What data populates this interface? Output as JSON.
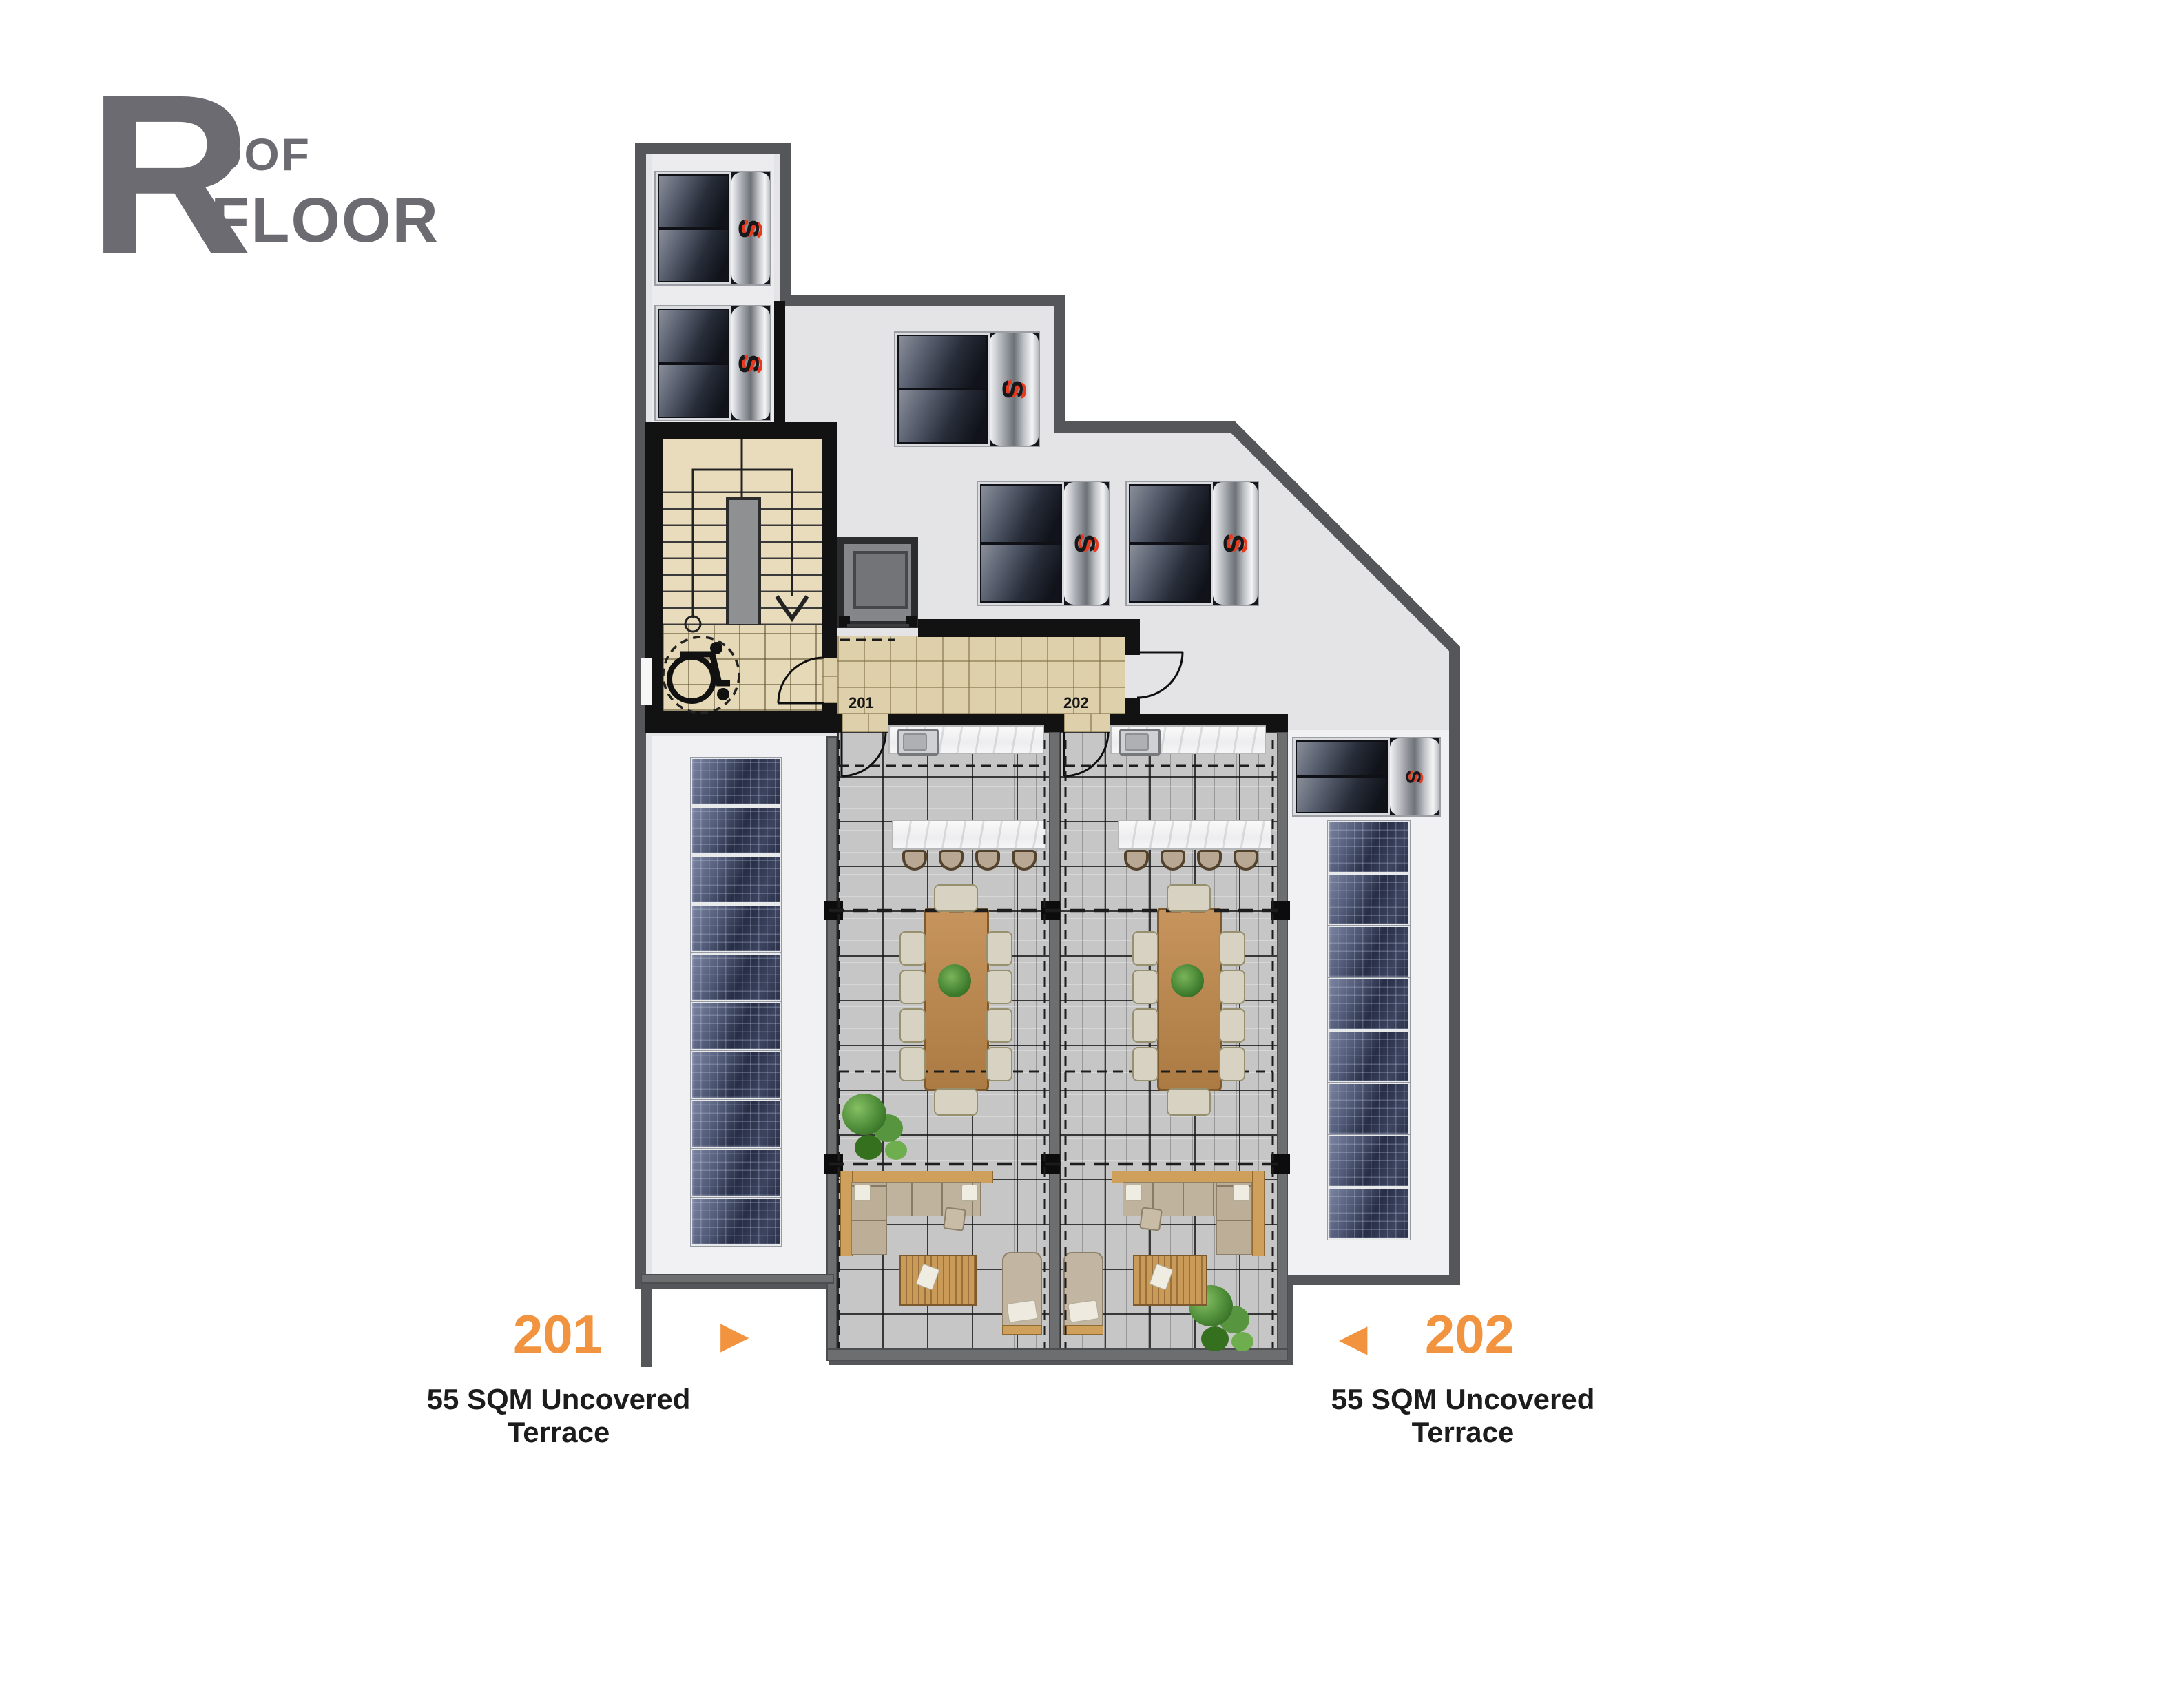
{
  "logo": {
    "initial": "R",
    "name_rest": "OOF",
    "name_second_line": "FLOOR"
  },
  "hallway": {
    "left_unit_door_label": "201",
    "right_unit_door_label": "202"
  },
  "legend": {
    "left": {
      "unit_number": "201",
      "arrow_icon": "▶",
      "caption": "55 SQM Uncovered Terrace"
    },
    "right": {
      "unit_number": "202",
      "arrow_icon": "◀",
      "caption": "55 SQM Uncovered Terrace"
    }
  },
  "icons": {
    "heater_brand_squiggle": "S"
  },
  "colors": {
    "accent_orange": "#F2943F",
    "logo_gray": "#6B6B71",
    "outer_wall_gray": "#545659",
    "inner_wall_black": "#121212",
    "terrace_wall_gray": "#6D6E70",
    "roof_surface": "#E4E4E6",
    "corridor_floor_beige": "#DDD0AB",
    "stair_floor_beige": "#E9DCBC",
    "terrace_tile_gray": "#C6C6C6",
    "pv_panel_navy": "#343A50",
    "label_black": "#1C1C1C"
  },
  "equipment": {
    "solar_water_heaters": 6,
    "pv_panels_left_array": 10,
    "pv_panels_right_array": 8,
    "bar_stools_per_terrace": 4,
    "dining_chairs_per_terrace": 10
  }
}
